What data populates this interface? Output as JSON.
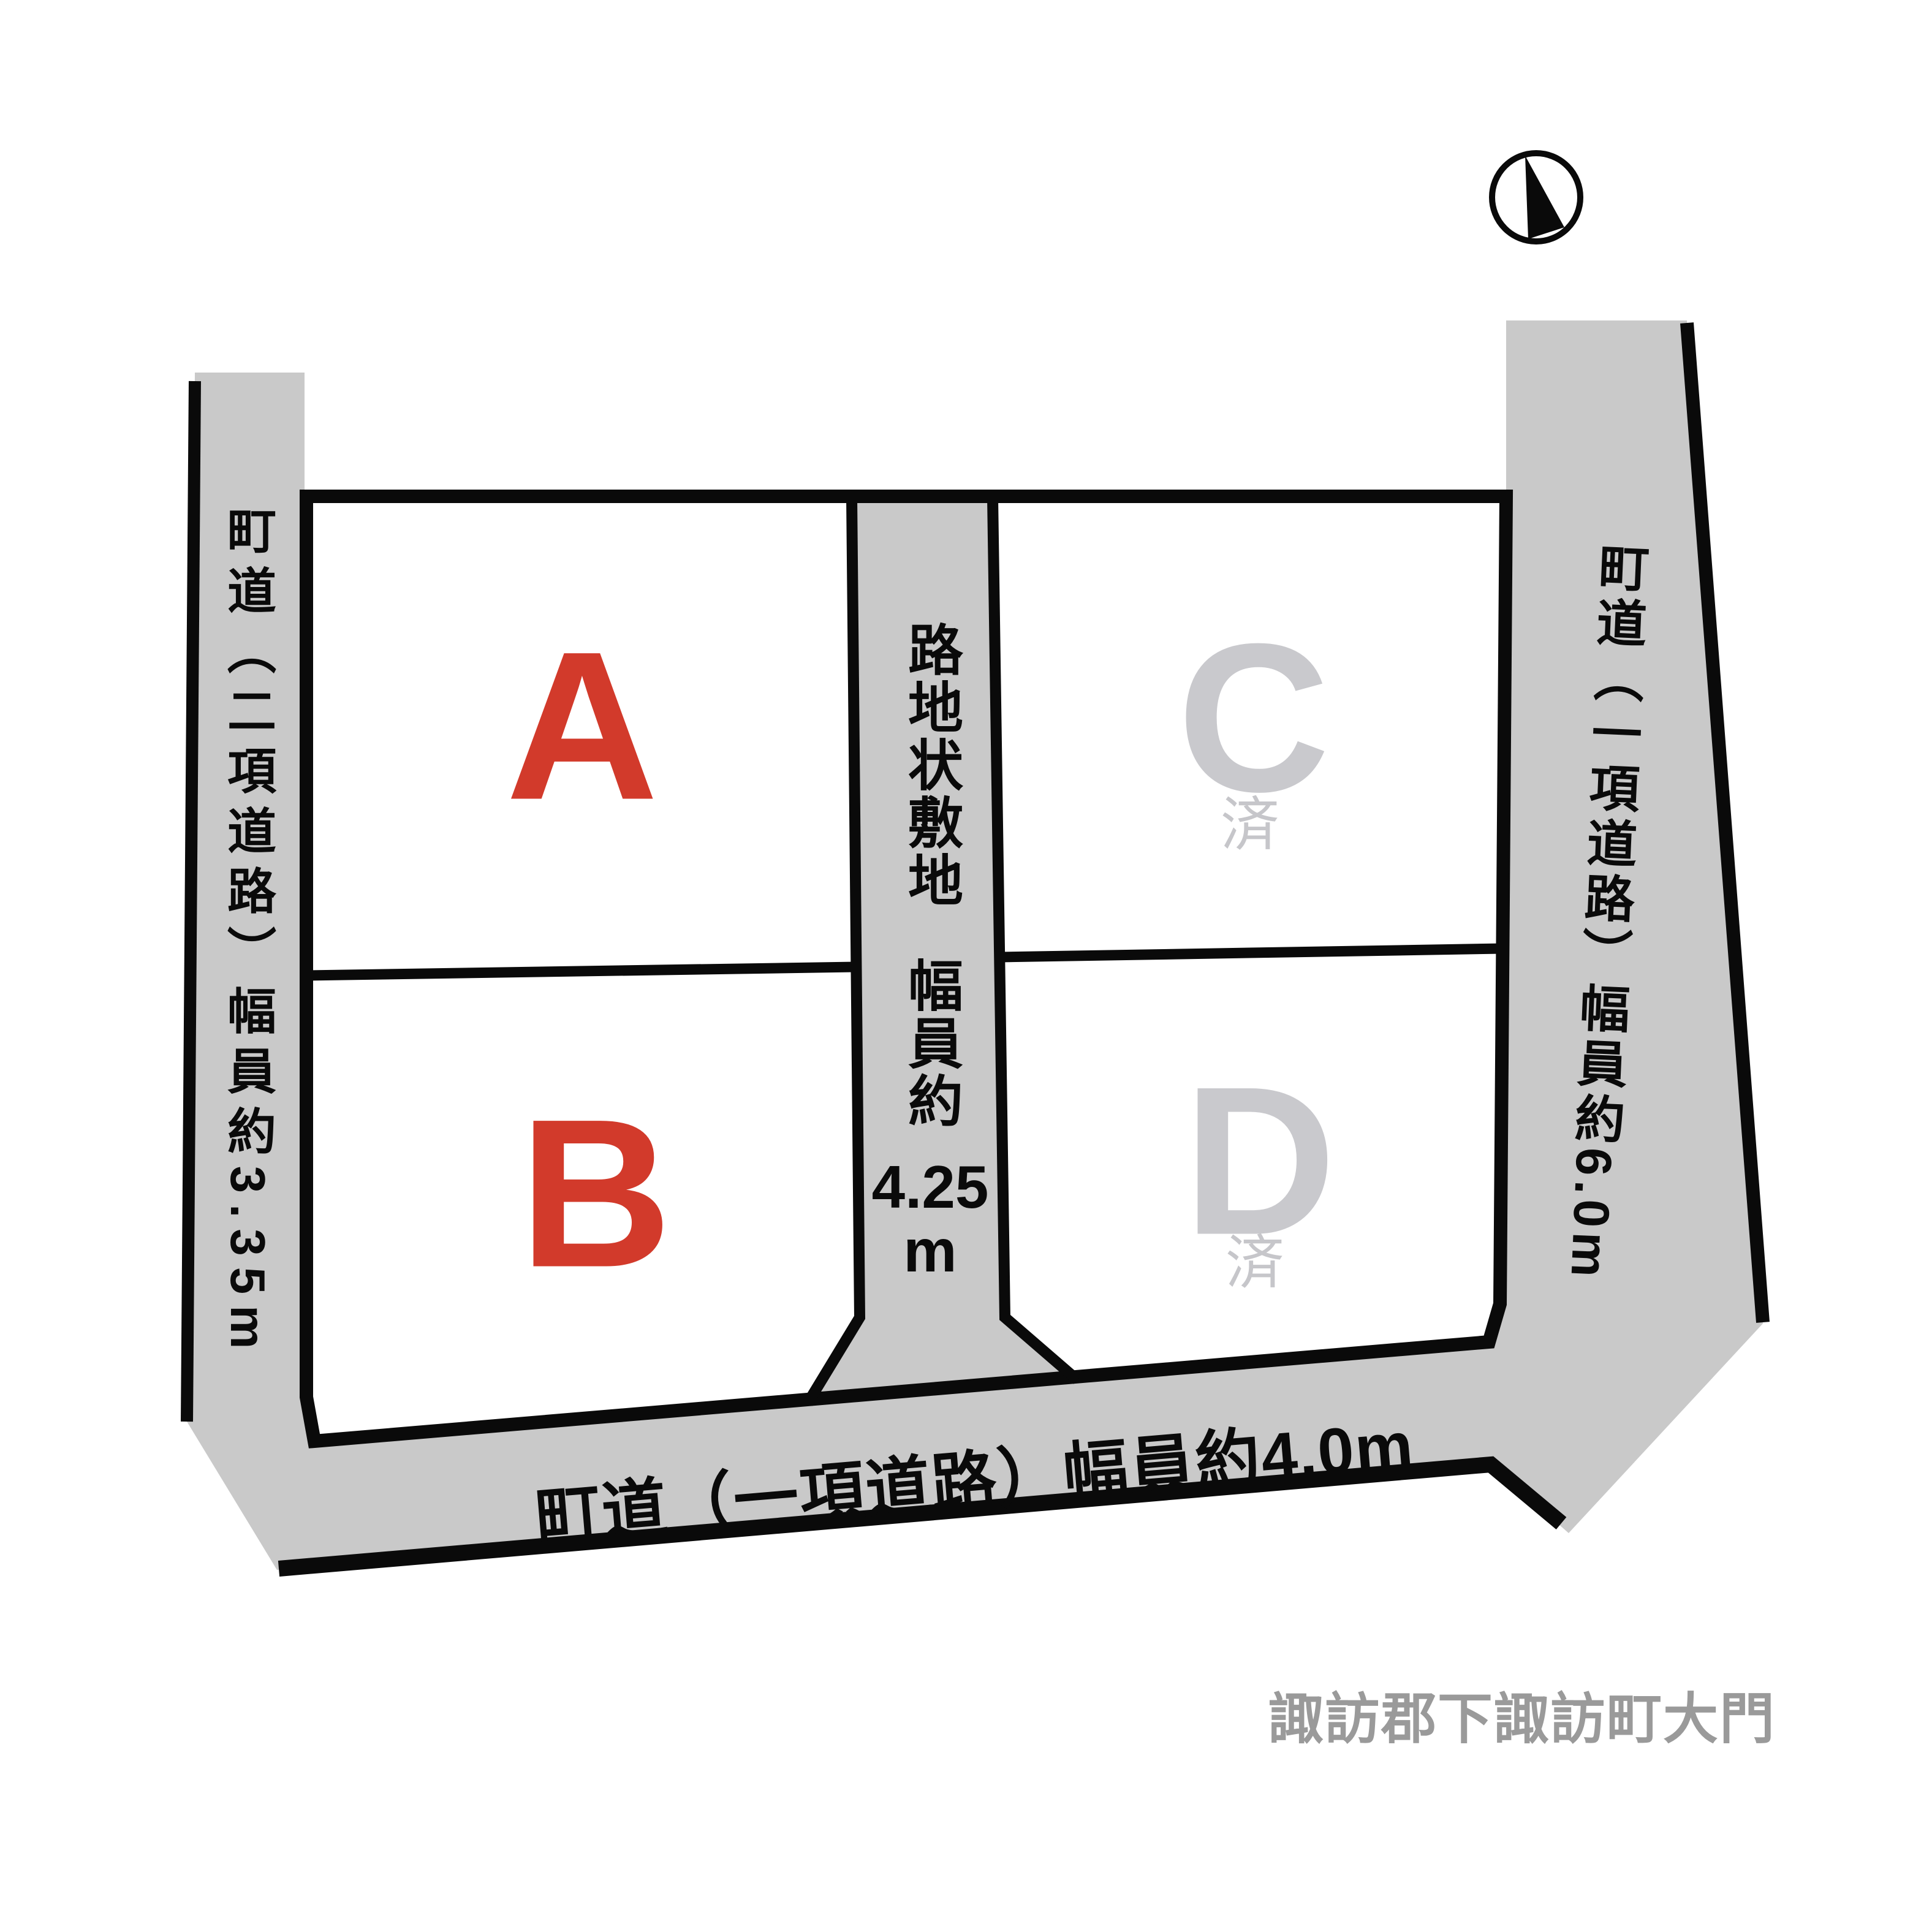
{
  "title": "lot-layout-diagram",
  "lots": [
    {
      "id": "A",
      "label": "A",
      "status": "",
      "color": "#d23a2b"
    },
    {
      "id": "B",
      "label": "B",
      "status": "",
      "color": "#d23a2b"
    },
    {
      "id": "C",
      "label": "C",
      "status": "済",
      "color": "#c9c9cd"
    },
    {
      "id": "D",
      "label": "D",
      "status": "済",
      "color": "#c9c9cd"
    }
  ],
  "roads": {
    "left": "町道（二項道路）幅員約3.35m",
    "right": "町道（一項道路）幅員約6.0m",
    "bottom": "町道（一項道路）幅員約4.0m",
    "strip": {
      "line1": "路地状敷地",
      "line2": "幅員約",
      "value": "4.25",
      "unit": "m"
    }
  },
  "address": "諏訪郡下諏訪町大門",
  "icons": {
    "compass": "north-arrow"
  },
  "colors": {
    "road_fill": "#c9c9c9",
    "boundary_line": "#0a0a0a",
    "lot_available_text": "#d23a2b",
    "lot_sold_text": "#c9c9cd",
    "address_text": "#9a9a9a",
    "background": "#ffffff"
  }
}
